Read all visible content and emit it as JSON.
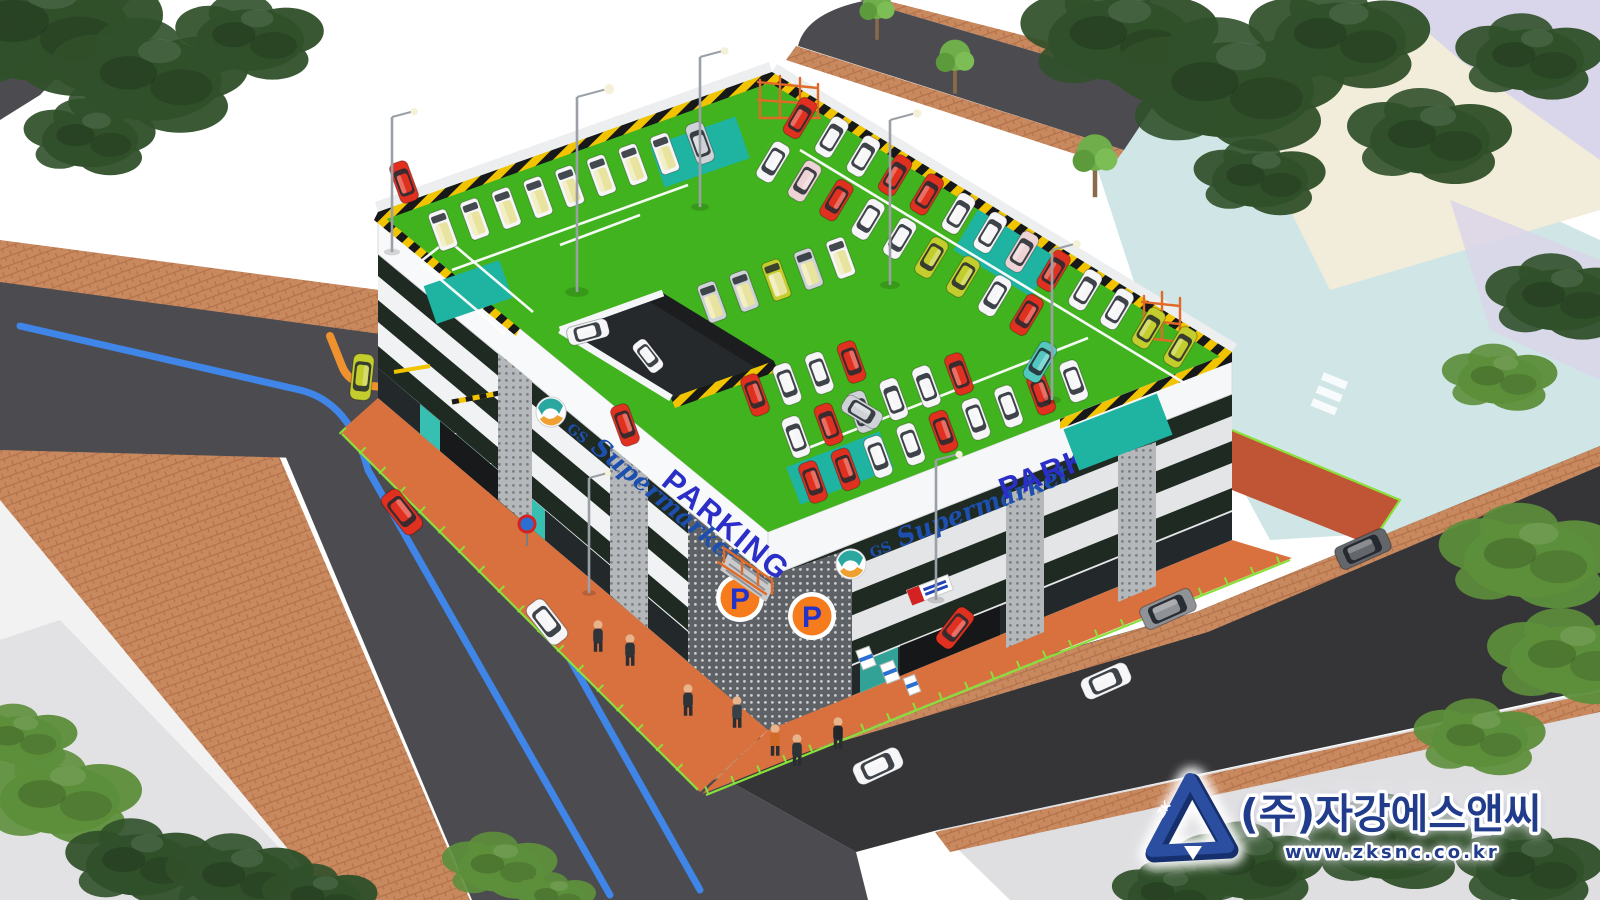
{
  "branding": {
    "brand_prefix": "GS",
    "brand_name": "Supermarket",
    "parking_label": "PARKING",
    "p_badge": "P"
  },
  "watermark": {
    "company": "(주)자강에스앤씨",
    "website": "www.zksnc.co.kr",
    "logo_monogram": "ZK"
  },
  "palette": {
    "roof_green": "#41b31e",
    "stall_teal": "#1fb3a2",
    "road": "#4c4c50",
    "road_dark": "#353538",
    "sidewalk_brick": "#c9895f",
    "brick_line": "#b4724a",
    "apron": "#d9713f",
    "facade": "#f1f2f4",
    "band_dark": "#1e2a22",
    "hazard_yellow": "#f2c400",
    "fence_green": "#8ae03a",
    "parking_blue": "#2b2fc8",
    "gs_blue": "#1d4fae",
    "p_orange": "#f57b1c",
    "navy": "#223c8c",
    "aqua_lot": "#cfe5e6",
    "cream_lot": "#f2ecda",
    "lavender_lot": "#d9d5ea",
    "pale_walk": "#dfdfe2",
    "tree_dark": "#30502a",
    "tree_light": "#5d8f3b",
    "pole": "#9aa0a6",
    "scaffold": "#e06a28",
    "glass_teal": "#37c0b2",
    "line_blue": "#3f86e8",
    "arrow_orange": "#f0912f"
  },
  "car_colors": {
    "red": "#e03020",
    "white": "#f6f6f8",
    "silver": "#cfd3d7",
    "yellow": "#c3cd2d",
    "pink": "#edd3d6",
    "teal": "#52c8c0",
    "gray": "#8f9297",
    "darkgray": "#63666b"
  },
  "vehicles": {
    "roof_rows": [
      {
        "x": 443,
        "y": 230,
        "dx": 31.7,
        "dy": -10.9,
        "rot": -110,
        "type": "van",
        "colors": [
          "white",
          "white",
          "white",
          "white",
          "white",
          "white",
          "white",
          "white"
        ]
      },
      {
        "x": 800,
        "y": 118,
        "dx": 31.7,
        "dy": 19.1,
        "rot": -59,
        "type": "car",
        "colors": [
          "red",
          "white",
          "white",
          "red",
          "red",
          "white",
          "white",
          "pink",
          "red",
          "white",
          "white",
          "yellow",
          "yellow"
        ]
      },
      {
        "x": 773,
        "y": 162,
        "dx": 31.7,
        "dy": 19.1,
        "rot": 121,
        "type": "car",
        "colors": [
          "white",
          "pink",
          "red",
          "white",
          "white",
          "yellow",
          "yellow",
          "white",
          "red"
        ]
      },
      {
        "x": 712,
        "y": 302,
        "dx": 32.2,
        "dy": -11,
        "rot": -110,
        "type": "van",
        "colors": [
          "silver",
          "silver",
          "yellow",
          "silver",
          "white"
        ]
      },
      {
        "x": 755,
        "y": 395,
        "dx": 32.2,
        "dy": -11,
        "rot": 70,
        "type": "car",
        "colors": [
          "red",
          "white",
          "white",
          "red"
        ]
      },
      {
        "x": 813,
        "y": 482,
        "dx": 32.6,
        "dy": -12.6,
        "rot": 70,
        "type": "car",
        "colors": [
          "red",
          "red",
          "white",
          "white",
          "red",
          "white",
          "white",
          "red",
          "white"
        ]
      },
      {
        "x": 796,
        "y": 437,
        "dx": 32.6,
        "dy": -12.6,
        "rot": -110,
        "type": "car",
        "colors": [
          "white",
          "red",
          "silver",
          "white",
          "white",
          "red"
        ]
      }
    ],
    "roof_singles": [
      {
        "x": 700,
        "y": 143,
        "rot": -110,
        "color": "silver"
      },
      {
        "x": 588,
        "y": 332,
        "rot": -15,
        "color": "white"
      },
      {
        "x": 625,
        "y": 425,
        "rot": 70,
        "color": "red"
      },
      {
        "x": 404,
        "y": 182,
        "rot": -110,
        "color": "red"
      },
      {
        "x": 1040,
        "y": 362,
        "rot": 121,
        "color": "teal"
      },
      {
        "x": 862,
        "y": 412,
        "rot": 31,
        "color": "silver"
      },
      {
        "x": 648,
        "y": 356,
        "rot": 52,
        "color": "white",
        "s": 0.85
      }
    ],
    "street": [
      {
        "x": 402,
        "y": 512,
        "rot": 52,
        "color": "red",
        "s": 1.15
      },
      {
        "x": 547,
        "y": 622,
        "rot": 52,
        "color": "white",
        "s": 1.15
      },
      {
        "x": 362,
        "y": 377,
        "rot": 96,
        "color": "yellow",
        "s": 1.1
      },
      {
        "x": 878,
        "y": 766,
        "rot": -25,
        "color": "white",
        "s": 1.2
      },
      {
        "x": 1106,
        "y": 681,
        "rot": -24,
        "color": "white",
        "s": 1.2
      },
      {
        "x": 1168,
        "y": 609,
        "rot": -24,
        "color": "gray",
        "type": "suv",
        "s": 1.15
      },
      {
        "x": 1363,
        "y": 549,
        "rot": -24,
        "color": "darkgray",
        "type": "suv",
        "s": 1.15
      },
      {
        "x": 955,
        "y": 628,
        "rot": 128,
        "color": "red",
        "s": 1.05
      }
    ]
  },
  "pedestrians": [
    {
      "x": 598,
      "y": 636,
      "c": "#30343a"
    },
    {
      "x": 630,
      "y": 650,
      "c": "#2e3338"
    },
    {
      "x": 688,
      "y": 700,
      "c": "#2e3338"
    },
    {
      "x": 737,
      "y": 712,
      "c": "#384048"
    },
    {
      "x": 775,
      "y": 740,
      "c": "#d06a2a"
    },
    {
      "x": 797,
      "y": 750,
      "c": "#2e3338"
    },
    {
      "x": 838,
      "y": 733,
      "c": "#23272b"
    }
  ],
  "trees": [
    {
      "x": 40,
      "y": 30,
      "s": 1.5,
      "tone": "dark"
    },
    {
      "x": 150,
      "y": 80,
      "s": 1.2,
      "tone": "dark"
    },
    {
      "x": 250,
      "y": 40,
      "s": 0.9,
      "tone": "dark"
    },
    {
      "x": 90,
      "y": 140,
      "s": 0.8,
      "tone": "dark"
    },
    {
      "x": 1120,
      "y": 40,
      "s": 1.2,
      "tone": "dark"
    },
    {
      "x": 1230,
      "y": 90,
      "s": 1.4,
      "tone": "dark"
    },
    {
      "x": 1340,
      "y": 40,
      "s": 1.1,
      "tone": "dark"
    },
    {
      "x": 1430,
      "y": 140,
      "s": 1.0,
      "tone": "dark"
    },
    {
      "x": 1530,
      "y": 60,
      "s": 0.9,
      "tone": "dark"
    },
    {
      "x": 1260,
      "y": 180,
      "s": 0.8,
      "tone": "dark"
    },
    {
      "x": 1560,
      "y": 300,
      "s": 0.9,
      "tone": "dark"
    },
    {
      "x": 1500,
      "y": 380,
      "s": 0.7,
      "tone": "light"
    },
    {
      "x": 1530,
      "y": 560,
      "s": 1.1,
      "tone": "light"
    },
    {
      "x": 1570,
      "y": 660,
      "s": 1.0,
      "tone": "light"
    },
    {
      "x": 1480,
      "y": 740,
      "s": 0.8,
      "tone": "light"
    },
    {
      "x": 60,
      "y": 800,
      "s": 1.0,
      "tone": "light"
    },
    {
      "x": 140,
      "y": 865,
      "s": 0.9,
      "tone": "dark"
    },
    {
      "x": 20,
      "y": 740,
      "s": 0.7,
      "tone": "light"
    },
    {
      "x": 240,
      "y": 880,
      "s": 0.9,
      "tone": "dark"
    },
    {
      "x": 320,
      "y": 900,
      "s": 0.7,
      "tone": "dark"
    },
    {
      "x": 500,
      "y": 868,
      "s": 0.7,
      "tone": "light"
    },
    {
      "x": 555,
      "y": 898,
      "s": 0.5,
      "tone": "light"
    },
    {
      "x": 1250,
      "y": 868,
      "s": 0.9,
      "tone": "dark"
    },
    {
      "x": 1390,
      "y": 845,
      "s": 1.0,
      "tone": "dark"
    },
    {
      "x": 1530,
      "y": 870,
      "s": 0.9,
      "tone": "dark"
    },
    {
      "x": 1170,
      "y": 896,
      "s": 0.7,
      "tone": "dark"
    }
  ],
  "street_trees": [
    {
      "x": 877,
      "y": 20,
      "s": 0.55
    },
    {
      "x": 955,
      "y": 72,
      "s": 0.6
    },
    {
      "x": 1095,
      "y": 172,
      "s": 0.7
    }
  ],
  "light_poles": [
    {
      "x": 577,
      "y": 292,
      "h": 195
    },
    {
      "x": 700,
      "y": 207,
      "h": 150
    },
    {
      "x": 890,
      "y": 285,
      "h": 165
    },
    {
      "x": 1052,
      "y": 400,
      "h": 150
    },
    {
      "x": 392,
      "y": 252,
      "h": 135
    },
    {
      "x": 589,
      "y": 593,
      "h": 115
    },
    {
      "x": 936,
      "y": 600,
      "h": 140
    }
  ]
}
